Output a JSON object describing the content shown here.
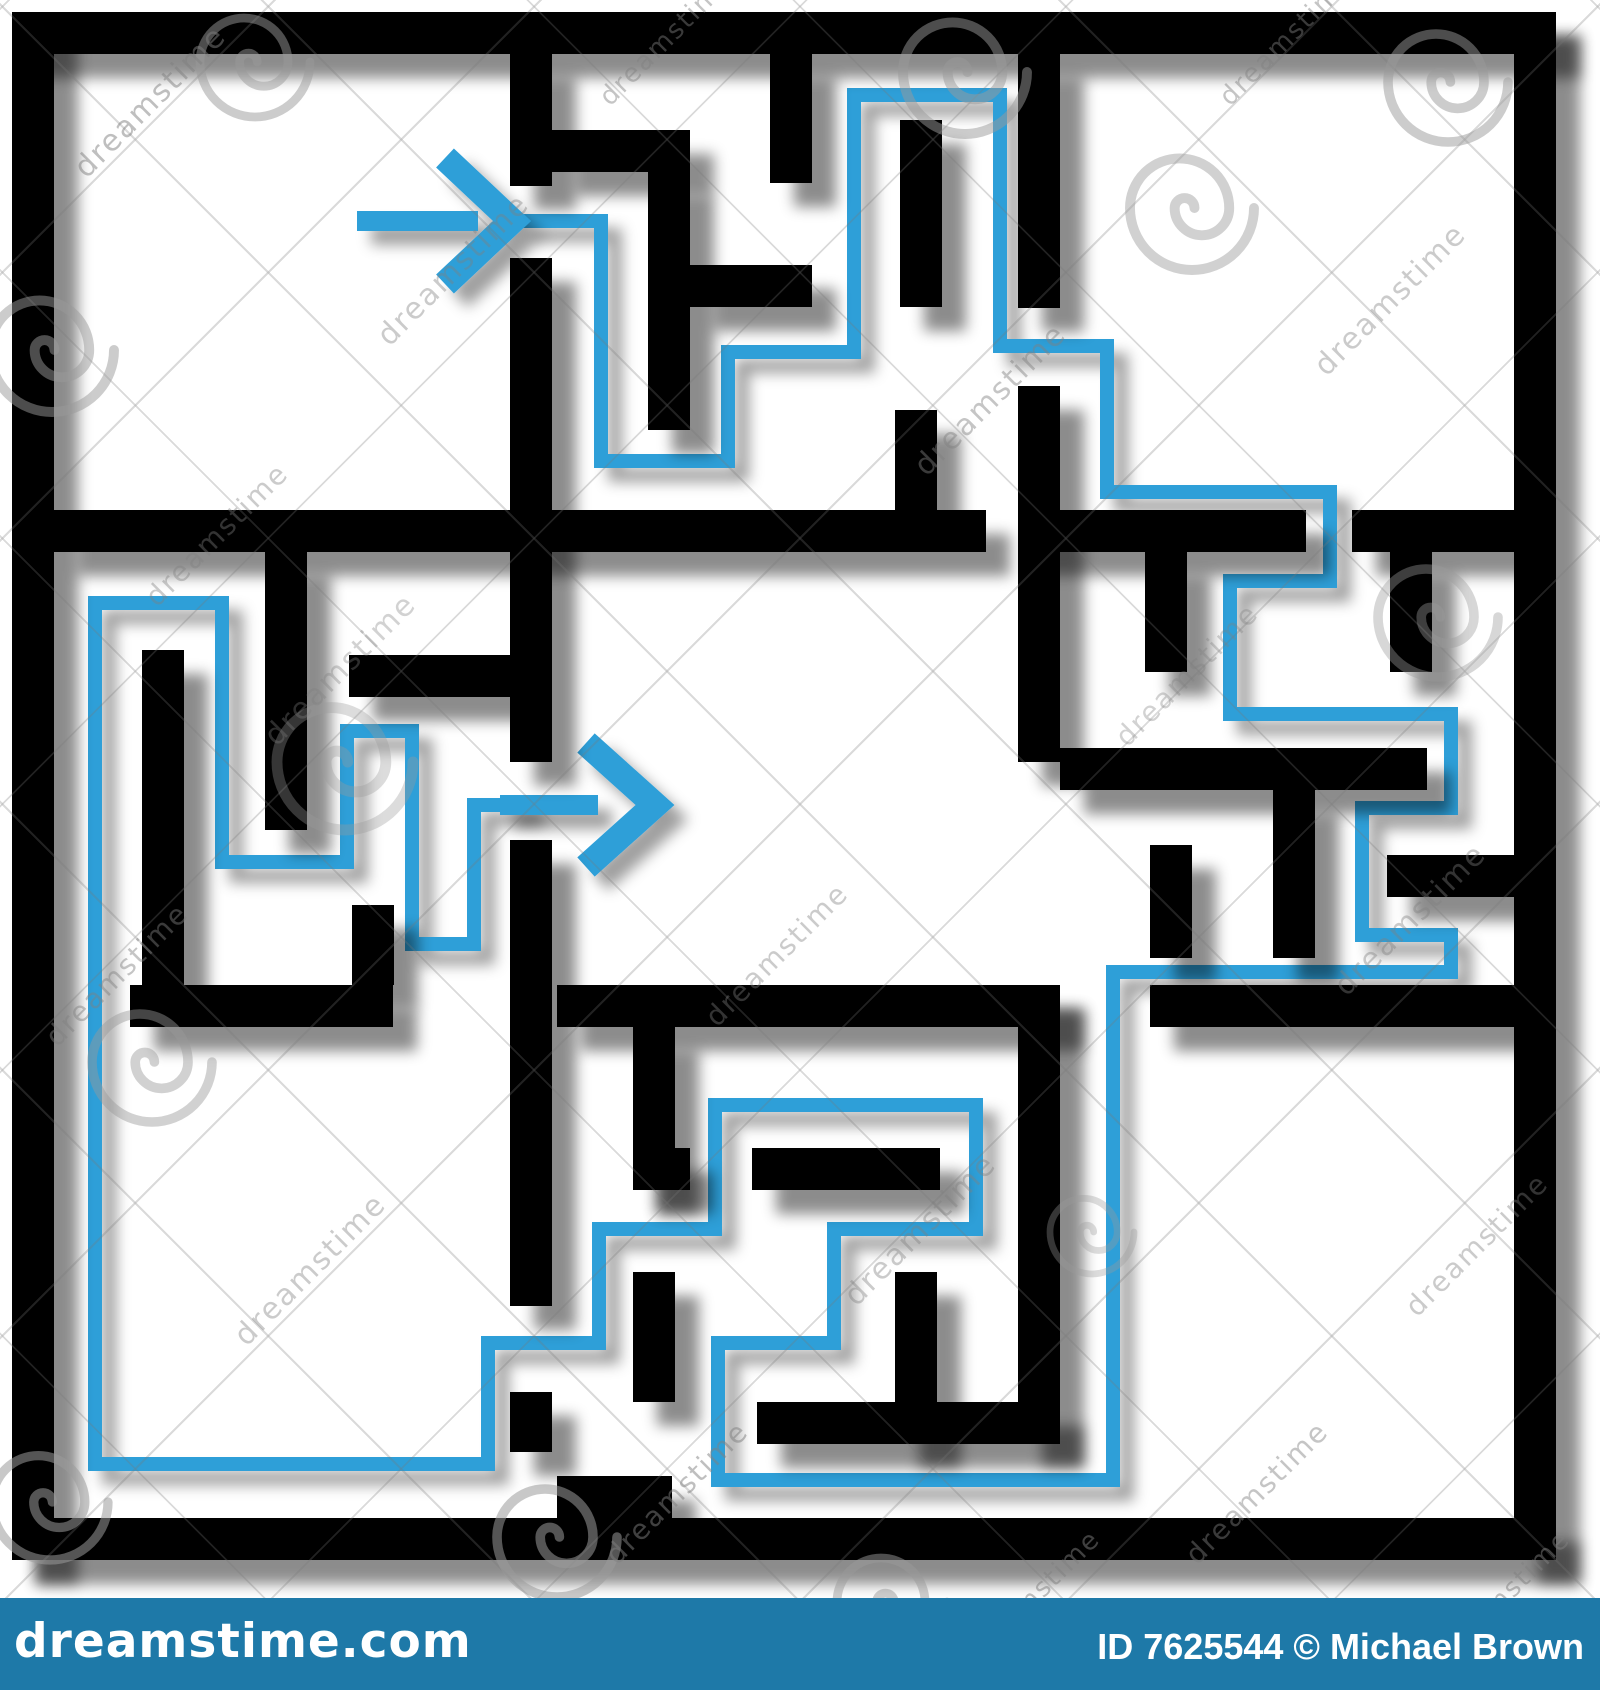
{
  "canvas": {
    "width": 1600,
    "height": 1690,
    "background": "#ffffff"
  },
  "maze": {
    "wall_color": "#000000",
    "wall_thickness": 42,
    "shadow_color": "rgba(0,0,0,0.45)",
    "walls": [
      {
        "name": "outer-top",
        "r": [
          12,
          12,
          1544,
          42
        ]
      },
      {
        "name": "outer-left",
        "r": [
          12,
          12,
          42,
          1548
        ]
      },
      {
        "name": "outer-right",
        "r": [
          1514,
          12,
          42,
          1548
        ]
      },
      {
        "name": "outer-bottom",
        "r": [
          12,
          1518,
          1544,
          42
        ]
      },
      {
        "name": "divider-left-1",
        "r": [
          510,
          54,
          42,
          132
        ]
      },
      {
        "name": "divider-left-2",
        "r": [
          510,
          258,
          42,
          504
        ]
      },
      {
        "name": "divider-left-3",
        "r": [
          510,
          840,
          42,
          466
        ]
      },
      {
        "name": "divider-left-4",
        "r": [
          510,
          1392,
          42,
          60
        ]
      },
      {
        "name": "divider-right-1",
        "r": [
          1018,
          54,
          42,
          254
        ]
      },
      {
        "name": "divider-right-2",
        "r": [
          1018,
          386,
          42,
          376
        ]
      },
      {
        "name": "divider-right-3",
        "r": [
          1018,
          985,
          42,
          458
        ]
      },
      {
        "name": "row1-a",
        "r": [
          54,
          510,
          932,
          42
        ]
      },
      {
        "name": "row1-b",
        "r": [
          1018,
          510,
          288,
          42
        ]
      },
      {
        "name": "row1-c",
        "r": [
          1352,
          510,
          162,
          42
        ]
      },
      {
        "name": "row2-a",
        "r": [
          130,
          985,
          263,
          42
        ]
      },
      {
        "name": "row2-b",
        "r": [
          557,
          985,
          503,
          42
        ]
      },
      {
        "name": "row2-c",
        "r": [
          1150,
          985,
          364,
          42
        ]
      },
      {
        "name": "topmid-L-h",
        "r": [
          552,
          130,
          138,
          42
        ]
      },
      {
        "name": "topmid-L-v",
        "r": [
          648,
          172,
          42,
          258
        ]
      },
      {
        "name": "topmid-stub-top",
        "r": [
          770,
          54,
          42,
          129
        ]
      },
      {
        "name": "topmid-h",
        "r": [
          690,
          265,
          122,
          42
        ]
      },
      {
        "name": "topmid-v-float",
        "r": [
          900,
          120,
          42,
          187
        ]
      },
      {
        "name": "topmid-v-div",
        "r": [
          895,
          410,
          42,
          100
        ]
      },
      {
        "name": "midleft-v1",
        "r": [
          265,
          552,
          42,
          278
        ]
      },
      {
        "name": "midleft-v2",
        "r": [
          142,
          650,
          42,
          335
        ]
      },
      {
        "name": "midleft-h1",
        "r": [
          349,
          655,
          161,
          42
        ]
      },
      {
        "name": "midleft-v3",
        "r": [
          352,
          905,
          42,
          80
        ]
      },
      {
        "name": "midright-hang1",
        "r": [
          1145,
          552,
          42,
          120
        ]
      },
      {
        "name": "midright-stub",
        "r": [
          1390,
          552,
          42,
          120
        ]
      },
      {
        "name": "midright-h1",
        "r": [
          1060,
          748,
          367,
          42
        ]
      },
      {
        "name": "midright-hang2",
        "r": [
          1273,
          790,
          42,
          168
        ]
      },
      {
        "name": "midright-h2",
        "r": [
          1387,
          855,
          127,
          42
        ]
      },
      {
        "name": "midright-v-float",
        "r": [
          1150,
          845,
          42,
          113
        ]
      },
      {
        "name": "botcen-hang",
        "r": [
          633,
          1027,
          42,
          163
        ]
      },
      {
        "name": "botcen-h1a",
        "r": [
          633,
          1148,
          57,
          42
        ]
      },
      {
        "name": "botcen-h1b",
        "r": [
          752,
          1148,
          188,
          42
        ]
      },
      {
        "name": "botcen-v1",
        "r": [
          895,
          1272,
          42,
          172
        ]
      },
      {
        "name": "botcen-h2",
        "r": [
          757,
          1402,
          303,
          42
        ]
      },
      {
        "name": "botcen-v2",
        "r": [
          633,
          1272,
          42,
          130
        ]
      },
      {
        "name": "botcen-notch",
        "r": [
          557,
          1476,
          115,
          42
        ]
      }
    ],
    "solution": {
      "color": "#2f9fd8",
      "stroke_width": 14,
      "points": [
        [
          522,
          221
        ],
        [
          601,
          221
        ],
        [
          601,
          461
        ],
        [
          728,
          461
        ],
        [
          728,
          352
        ],
        [
          854,
          352
        ],
        [
          854,
          95
        ],
        [
          1000,
          95
        ],
        [
          1000,
          346
        ],
        [
          1107,
          346
        ],
        [
          1107,
          492
        ],
        [
          1330,
          492
        ],
        [
          1330,
          581
        ],
        [
          1230,
          581
        ],
        [
          1230,
          714
        ],
        [
          1451,
          714
        ],
        [
          1451,
          808
        ],
        [
          1362,
          808
        ],
        [
          1362,
          935
        ],
        [
          1451,
          935
        ],
        [
          1451,
          972
        ],
        [
          1113,
          972
        ],
        [
          1113,
          1480
        ],
        [
          718,
          1480
        ],
        [
          718,
          1343
        ],
        [
          834,
          1343
        ],
        [
          834,
          1229
        ],
        [
          976,
          1229
        ],
        [
          976,
          1105
        ],
        [
          715,
          1105
        ],
        [
          715,
          1229
        ],
        [
          599,
          1229
        ],
        [
          599,
          1343
        ],
        [
          488,
          1343
        ],
        [
          488,
          1464
        ],
        [
          95,
          1464
        ],
        [
          95,
          603
        ],
        [
          222,
          603
        ],
        [
          222,
          862
        ],
        [
          347,
          862
        ],
        [
          347,
          731
        ],
        [
          412,
          731
        ],
        [
          412,
          944
        ],
        [
          474,
          944
        ],
        [
          474,
          805
        ],
        [
          530,
          805
        ]
      ]
    },
    "arrows": {
      "start": {
        "shaft": [
          357,
          221,
          478,
          221
        ],
        "tip": [
          512,
          221
        ],
        "wing_top": [
          445,
          158
        ],
        "wing_bottom": [
          445,
          284
        ],
        "shaft_width": 20,
        "head_width": 26
      },
      "finish": {
        "shaft": [
          500,
          805,
          598,
          805
        ],
        "tip": [
          655,
          805
        ],
        "wing_top": [
          586,
          743
        ],
        "wing_bottom": [
          586,
          867
        ],
        "shaft_width": 20,
        "head_width": 26
      }
    }
  },
  "watermark": {
    "text": "dreamstime",
    "text_color": "#808080",
    "spiral_color": "#9a9a9a",
    "spirals": [
      [
        255,
        62,
        55,
        0.5
      ],
      [
        965,
        72,
        62,
        0.5
      ],
      [
        1448,
        82,
        60,
        0.5
      ],
      [
        52,
        350,
        62,
        0.5
      ],
      [
        152,
        1062,
        60,
        0.45
      ],
      [
        345,
        762,
        68,
        0.35
      ],
      [
        1192,
        208,
        62,
        0.45
      ],
      [
        1438,
        617,
        60,
        0.4
      ],
      [
        50,
        1502,
        58,
        0.55
      ],
      [
        557,
        1537,
        60,
        0.55
      ],
      [
        892,
        1602,
        55,
        0.5
      ],
      [
        1092,
        1232,
        42,
        0.35
      ]
    ],
    "texts": [
      [
        92,
        180,
        30,
        0.5
      ],
      [
        615,
        108,
        26,
        0.45
      ],
      [
        1235,
        108,
        26,
        0.45
      ],
      [
        395,
        348,
        30,
        0.4
      ],
      [
        1332,
        378,
        30,
        0.4
      ],
      [
        162,
        608,
        28,
        0.4
      ],
      [
        932,
        478,
        30,
        0.45
      ],
      [
        282,
        748,
        30,
        0.35
      ],
      [
        1132,
        748,
        28,
        0.35
      ],
      [
        62,
        1048,
        28,
        0.45
      ],
      [
        722,
        1028,
        28,
        0.4
      ],
      [
        1352,
        998,
        30,
        0.4
      ],
      [
        252,
        1348,
        30,
        0.4
      ],
      [
        862,
        1308,
        30,
        0.4
      ],
      [
        1422,
        1318,
        28,
        0.4
      ],
      [
        622,
        1566,
        28,
        0.5
      ],
      [
        1202,
        1566,
        28,
        0.45
      ],
      [
        982,
        1666,
        26,
        0.5
      ],
      [
        1452,
        1666,
        26,
        0.5
      ]
    ]
  },
  "footer": {
    "bar_color": "#1e79a8",
    "text_color": "#ffffff",
    "logo": "dreamstime.com",
    "credit": "ID 7625544 © Michael Brown",
    "logo_spiral": [
      209,
      1612,
      11
    ]
  }
}
